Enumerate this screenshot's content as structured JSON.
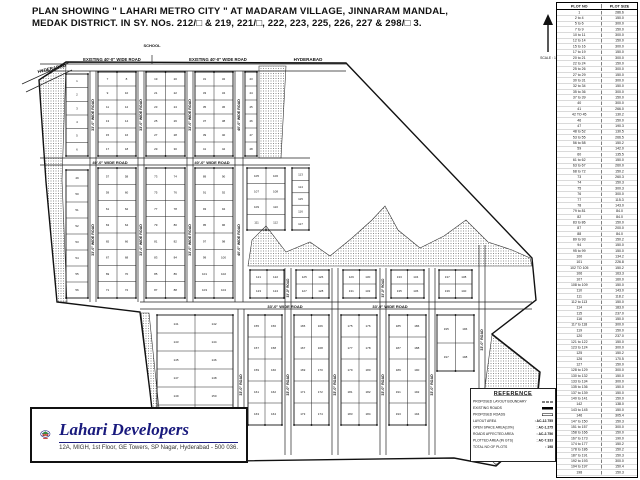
{
  "title": {
    "line1": "PLAN SHOWING \" LAHARI METRO CITY \" AT MADARAM VILLAGE, JINNARAM MANDAL,",
    "line2": "MEDAK DISTRICT. IN SY. NOs. 212/□ & 219, 221/□, 222, 223, 225, 226, 227 & 298/□ 3."
  },
  "north": {
    "scale_label": "SCALE : 1"
  },
  "map": {
    "labels": [
      {
        "text": "EXISTING 40'-0\" WIDE ROAD",
        "x": 112,
        "y": 61,
        "rot": 0,
        "fs": 4.2
      },
      {
        "text": "EXISTING 40'-0\" WIDE ROAD",
        "x": 218,
        "y": 61,
        "rot": 0,
        "fs": 4.2
      },
      {
        "text": "HYDERABAD",
        "x": 52,
        "y": 70,
        "rot": -13,
        "fs": 4.5
      },
      {
        "text": "HYDERABAD",
        "x": 308,
        "y": 61,
        "rot": 0,
        "fs": 4.5
      },
      {
        "text": "SCHOOL",
        "x": 152,
        "y": 47,
        "rot": 0,
        "fs": 4
      },
      {
        "text": "40'-0\" WIDE ROAD",
        "x": 110,
        "y": 163.8,
        "rot": 0,
        "fs": 4
      },
      {
        "text": "40'-0\" WIDE ROAD",
        "x": 212,
        "y": 163.8,
        "rot": 0,
        "fs": 4
      },
      {
        "text": "33'-0\" WIDE ROAD",
        "x": 285,
        "y": 307.8,
        "rot": 0,
        "fs": 4
      },
      {
        "text": "33'-0\" WIDE ROAD",
        "x": 390,
        "y": 307.8,
        "rot": 0,
        "fs": 4
      },
      {
        "text": "33'-0\" WIDE ROAD",
        "x": 94,
        "y": 115,
        "rot": -90,
        "fs": 3.6
      },
      {
        "text": "33'-0\" WIDE ROAD",
        "x": 142,
        "y": 115,
        "rot": -90,
        "fs": 3.6
      },
      {
        "text": "33'-0\" WIDE ROAD",
        "x": 191,
        "y": 115,
        "rot": -90,
        "fs": 3.6
      },
      {
        "text": "40'-0\" WIDE ROAD",
        "x": 240,
        "y": 115,
        "rot": -90,
        "fs": 3.6
      },
      {
        "text": "33'-0\" WIDE ROAD",
        "x": 94,
        "y": 240,
        "rot": -90,
        "fs": 3.6
      },
      {
        "text": "33'-0\" WIDE ROAD",
        "x": 142,
        "y": 240,
        "rot": -90,
        "fs": 3.6
      },
      {
        "text": "33'-0\" WIDE ROAD",
        "x": 191,
        "y": 240,
        "rot": -90,
        "fs": 3.6
      },
      {
        "text": "40'-0\" WIDE ROAD",
        "x": 240,
        "y": 240,
        "rot": -90,
        "fs": 3.6
      },
      {
        "text": "33'-0\" ROAD",
        "x": 242,
        "y": 385,
        "rot": -90,
        "fs": 3.6
      },
      {
        "text": "33'-0\" ROAD",
        "x": 289,
        "y": 385,
        "rot": -90,
        "fs": 3.6
      },
      {
        "text": "33'-0\" ROAD",
        "x": 336,
        "y": 385,
        "rot": -90,
        "fs": 3.6
      },
      {
        "text": "33'-0\" ROAD",
        "x": 384,
        "y": 385,
        "rot": -90,
        "fs": 3.6
      },
      {
        "text": "33'-0\" ROAD",
        "x": 433,
        "y": 385,
        "rot": -90,
        "fs": 3.6
      },
      {
        "text": "33'-0\" ROAD",
        "x": 483,
        "y": 340,
        "rot": -90,
        "fs": 3.6
      },
      {
        "text": "33'-0\" ROAD",
        "x": 289,
        "y": 288,
        "rot": -90,
        "fs": 3.2
      },
      {
        "text": "33'-0\" ROAD",
        "x": 384,
        "y": 288,
        "rot": -90,
        "fs": 3.2
      }
    ]
  },
  "plot_table": {
    "headers": [
      "PLOT NO",
      "PLOT SIZE"
    ],
    "rows": [
      [
        "1",
        "286.6"
      ],
      [
        "2 to 4",
        "150.0"
      ],
      [
        "5 to 6",
        "300.0"
      ],
      [
        "7 to 9",
        "150.0"
      ],
      [
        "10 to 11",
        "300.0"
      ],
      [
        "12 to 14",
        "150.0"
      ],
      [
        "15 to 16",
        "300.0"
      ],
      [
        "17 to 19",
        "150.0"
      ],
      [
        "20 to 21",
        "300.0"
      ],
      [
        "22 to 24",
        "150.0"
      ],
      [
        "25 to 26",
        "300.0"
      ],
      [
        "27 to 29",
        "150.0"
      ],
      [
        "30 to 31",
        "300.0"
      ],
      [
        "32 to 34",
        "150.0"
      ],
      [
        "35 to 36",
        "300.0"
      ],
      [
        "37 to 39",
        "150.0"
      ],
      [
        "40",
        "300.0"
      ],
      [
        "41",
        "266.0"
      ],
      [
        "42 TO 45",
        "130.2"
      ],
      [
        "46",
        "150.0"
      ],
      [
        "47",
        "190.3"
      ],
      [
        "48 to 52",
        "130.5"
      ],
      [
        "53 to 55",
        "266.5"
      ],
      [
        "56 to 58",
        "150.2"
      ],
      [
        "59",
        "142.0"
      ],
      [
        "60",
        "135.5"
      ],
      [
        "61 to 62",
        "150.0"
      ],
      [
        "63 to 67",
        "260.0"
      ],
      [
        "68 to 72",
        "150.2"
      ],
      [
        "73",
        "260.3"
      ],
      [
        "74",
        "150.3"
      ],
      [
        "75",
        "300.3"
      ],
      [
        "76",
        "300.0"
      ],
      [
        "77",
        "115.3"
      ],
      [
        "78",
        "143.0"
      ],
      [
        "79 to 81",
        "84.0"
      ],
      [
        "82",
        "84.0"
      ],
      [
        "83 to 86",
        "150.0"
      ],
      [
        "87",
        "200.0"
      ],
      [
        "88",
        "84.0"
      ],
      [
        "89 to 93",
        "150.2"
      ],
      [
        "94",
        "150.0"
      ],
      [
        "95 to 99",
        "150.0"
      ],
      [
        "100",
        "134.2"
      ],
      [
        "101",
        "226.8"
      ],
      [
        "102 TO 105",
        "150.2"
      ],
      [
        "106",
        "163.3"
      ],
      [
        "107",
        "160.0"
      ],
      [
        "108 to 109",
        "150.0"
      ],
      [
        "110",
        "143.0"
      ],
      [
        "111",
        "118.2"
      ],
      [
        "112 to 113",
        "150.0"
      ],
      [
        "114",
        "183.0"
      ],
      [
        "115",
        "237.0"
      ],
      [
        "116",
        "150.0"
      ],
      [
        "117 to 118",
        "300.0"
      ],
      [
        "119",
        "150.0"
      ],
      [
        "120",
        "237.0"
      ],
      [
        "121 to 122",
        "150.0"
      ],
      [
        "123 to 124",
        "300.0"
      ],
      [
        "125",
        "150.2"
      ],
      [
        "126",
        "170.5"
      ],
      [
        "127",
        "150.0"
      ],
      [
        "128 to 129",
        "300.0"
      ],
      [
        "130 to 132",
        "150.0"
      ],
      [
        "133 to 134",
        "300.0"
      ],
      [
        "135 to 136",
        "150.0"
      ],
      [
        "137 to 139",
        "150.0"
      ],
      [
        "140 to 141",
        "150.0"
      ],
      [
        "142",
        "138.0"
      ],
      [
        "143 to 145",
        "150.0"
      ],
      [
        "146",
        "305.4"
      ],
      [
        "147 to 150",
        "150.3"
      ],
      [
        "151 to 157",
        "300.0"
      ],
      [
        "158 to 166",
        "150.0"
      ],
      [
        "167 to 173",
        "190.0"
      ],
      [
        "174 to 177",
        "150.2"
      ],
      [
        "178 to 186",
        "150.2"
      ],
      [
        "187 to 191",
        "150.3"
      ],
      [
        "192 to 193",
        "300.0"
      ],
      [
        "194 to 197",
        "150.4"
      ],
      [
        "198",
        "150.3"
      ]
    ]
  },
  "reference": {
    "title": "REFERENCE",
    "items": [
      {
        "label": "PROPOSED LAYOUT BOUNDARY",
        "value": "",
        "symbol": "dashed"
      },
      {
        "label": "EXISTING ROADS",
        "value": "",
        "symbol": "solid"
      },
      {
        "label": "PROPOSED ROADS",
        "value": "",
        "symbol": "open"
      },
      {
        "label": "LAYOUT AREA",
        "value": ": AC-12.755",
        "symbol": ""
      },
      {
        "label": "OPEN SPACE AREA(10%)",
        "value": ": AC-1.275",
        "symbol": ""
      },
      {
        "label": "ROADS AFFECTED AREA",
        "value": ": AC-2.756",
        "symbol": ""
      },
      {
        "label": "PLOTTED AREA (IN GTS)",
        "value": ": AC-7.333",
        "symbol": ""
      },
      {
        "label": "TOTAL NO OF PLOTS",
        "value": ": 198",
        "symbol": ""
      }
    ]
  },
  "logo": {
    "company": "Lahari Developers",
    "address": "12A, MIGH, 1st Floor, GE Towers, SP Nagar, Hyderabad - 500 036.",
    "accent_color": "#191a7d",
    "roof_color": "#2f9e2f",
    "wall_color": "#c23327"
  }
}
